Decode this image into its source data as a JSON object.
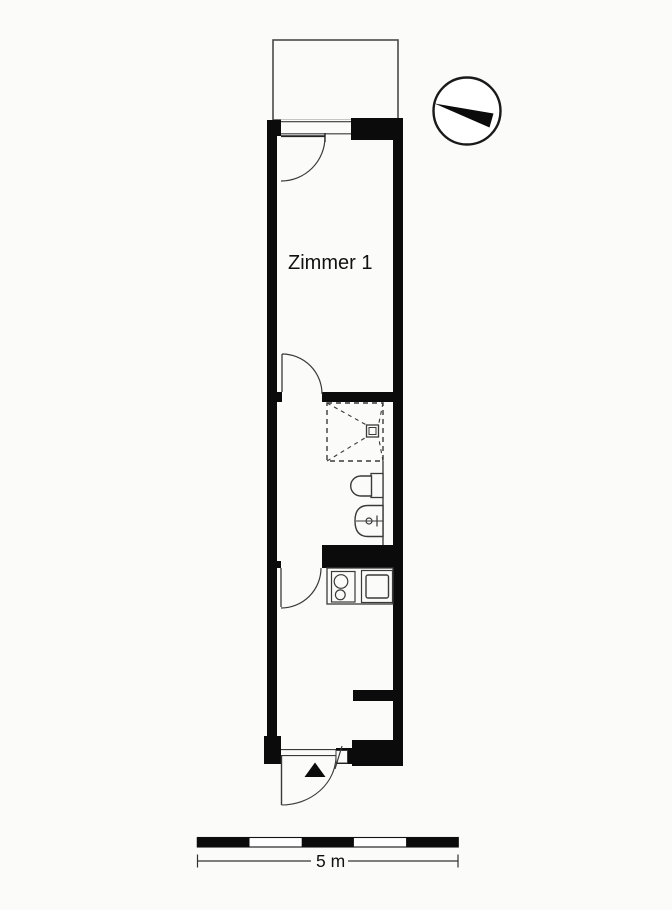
{
  "floorplan": {
    "type": "apartment-floor-plan",
    "rooms": [
      {
        "label": "Zimmer 1"
      }
    ],
    "scale": {
      "label": "5 m",
      "segments": 5
    },
    "colors": {
      "background": "#fbfbf9",
      "wall": "#0b0b0b",
      "thin_line": "#3a3a3a",
      "balcony_outline": "#4a4a4a"
    },
    "icons": [
      "compass-icon",
      "entrance-arrow-icon"
    ],
    "fixtures": [
      "balcony",
      "balcony-door-window",
      "room-door",
      "shower",
      "shower-drain",
      "toilet",
      "wash-basin",
      "hall-door",
      "stove",
      "kitchen-sink",
      "entrance-door",
      "scale-bar"
    ]
  }
}
